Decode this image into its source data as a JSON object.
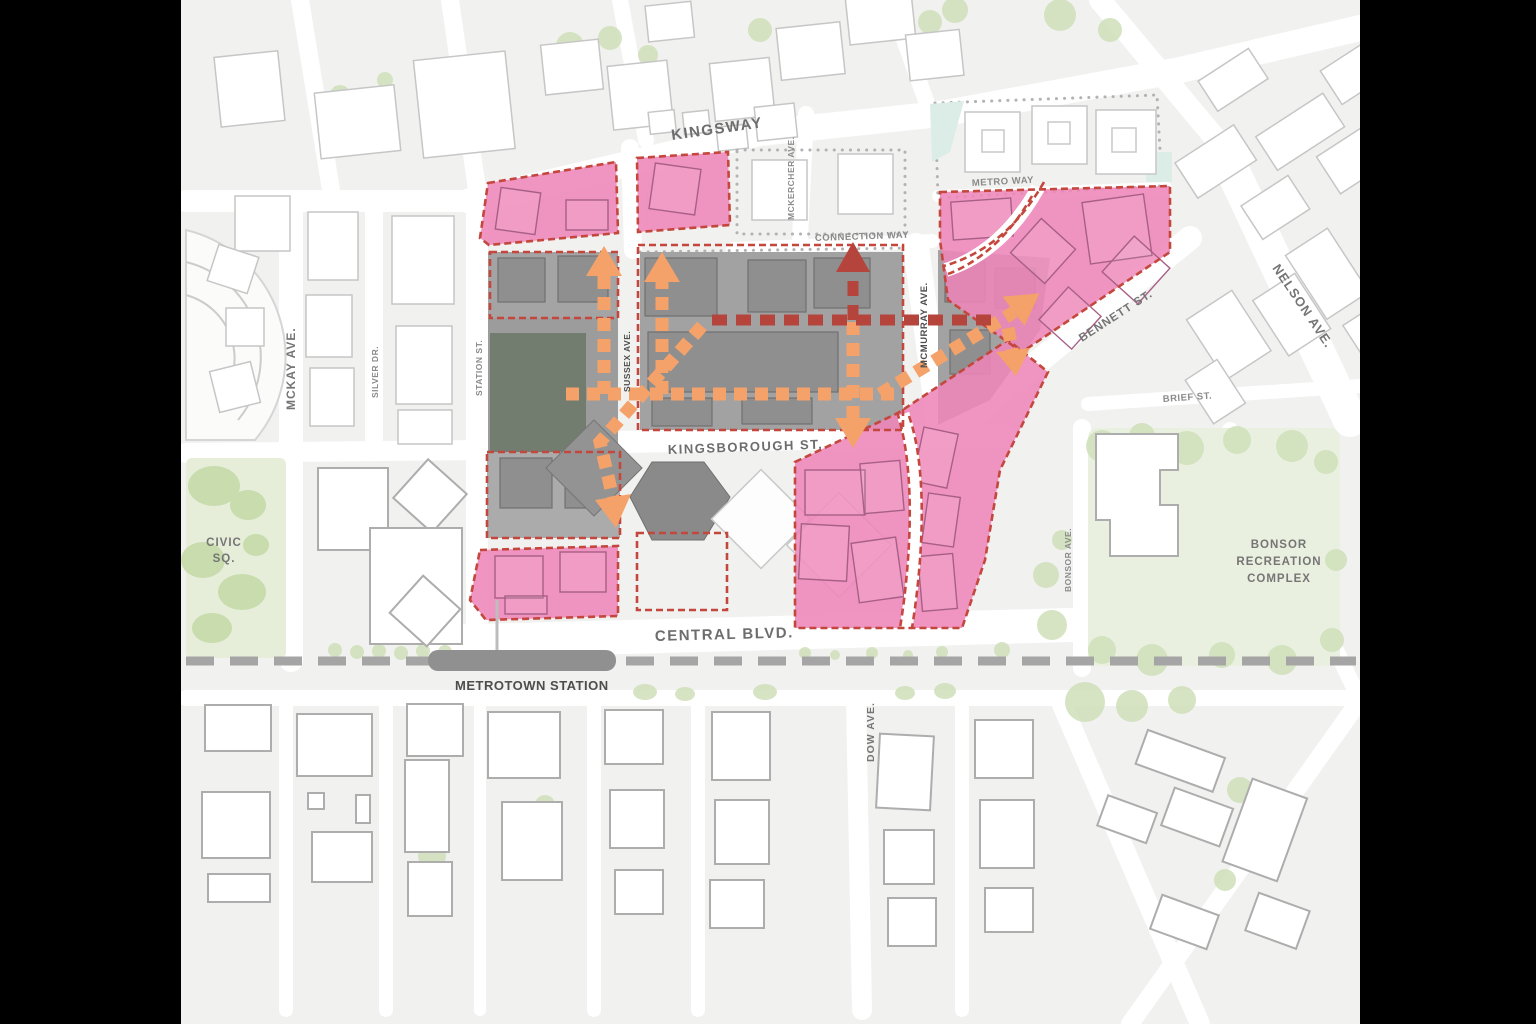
{
  "map": {
    "labels": {
      "kingsway": "KINGSWAY",
      "mckay": "MCKAY AVE.",
      "silver": "SILVER DR.",
      "station_st": "STATION ST.",
      "sussex": "SUSSEX AVE.",
      "mckercher": "MCKERCHER AVE.",
      "connection_way": "CONNECTION WAY",
      "metro_way": "METRO WAY",
      "mcmurray": "MCMURRAY AVE.",
      "bennett": "BENNETT ST.",
      "nelson": "NELSON AVE.",
      "brief": "BRIEF ST.",
      "kingsborough": "KINGSBOROUGH ST.",
      "central": "CENTRAL BLVD.",
      "metrotown_station": "METROTOWN STATION",
      "civic_line1": "CIVIC",
      "civic_line2": "SQ.",
      "bonsor_line1": "BONSOR",
      "bonsor_line2": "RECREATION",
      "bonsor_line3": "COMPLEX",
      "bonsor_ave": "BONSOR AVE.",
      "dow": "DOW AVE."
    },
    "colors": {
      "parcel_pink": "#ee85b8",
      "parcel_border_red": "#c4473d",
      "route_orange": "#f4a269",
      "route_dark_red": "#b5443c",
      "mall_gray": "#a2a2a2",
      "mall_dark_building": "#727d70",
      "park_green": "#e6edd9",
      "tree_green": "#cfe0ba",
      "plaza_teal": "#dcede7",
      "rail_gray": "#a3a3a3",
      "block_gray": "#f1f1f0"
    }
  }
}
